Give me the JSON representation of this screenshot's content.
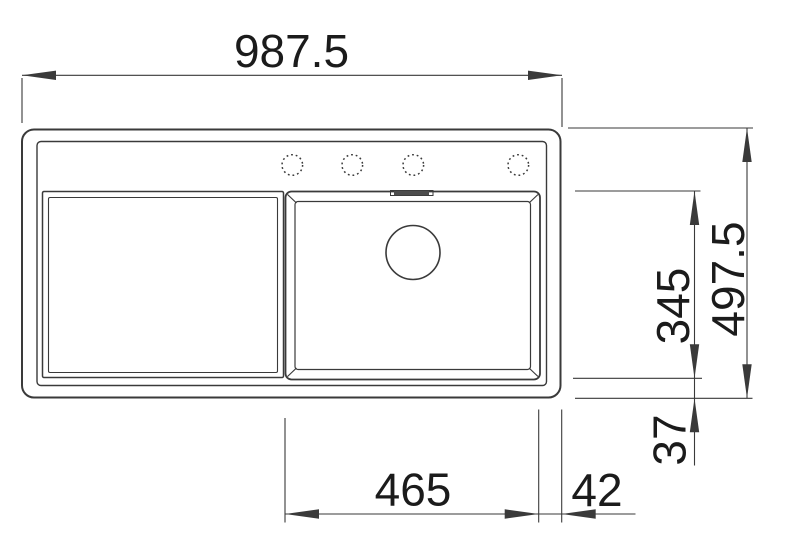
{
  "diagram": {
    "subject": "kitchen-sink-top-view-technical-drawing",
    "colors": {
      "line": "#3a3a3a",
      "text": "#1b1b1b",
      "background": "#ffffff",
      "overflow_slot": "#4d4d4d"
    },
    "dimensions": {
      "overall_width": "987.5",
      "overall_depth": "497.5",
      "bowl_depth": "345",
      "bowl_bottom_offset": "37",
      "bowl_width": "465",
      "bowl_right_offset": "42"
    },
    "features": {
      "faucet_hole_count": 4,
      "drain_count": 1
    }
  }
}
